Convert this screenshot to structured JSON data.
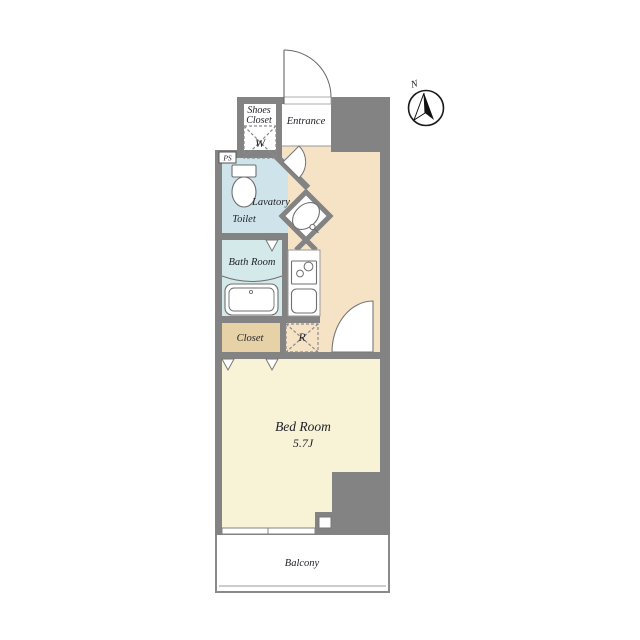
{
  "plan": {
    "title": "studio-apartment-floorplan",
    "compass": {
      "north_label": "N"
    },
    "labels": {
      "shoes_closet_line1": "Shoes",
      "shoes_closet_line2": "Closet",
      "entrance": "Entrance",
      "washer": "W",
      "pipe_space": "PS",
      "lavatory": "Lavatory",
      "toilet": "Toilet",
      "bath_room": "Bath Room",
      "closet": "Closet",
      "refrigerator": "R",
      "bedroom": "Bed Room",
      "bedroom_size": "5.7J",
      "balcony": "Balcony"
    },
    "colors": {
      "wall": "#838383",
      "hall_floor": "#f6e3c6",
      "bedroom_floor": "#f8f3d7",
      "toilet_floor": "#cfe4ea",
      "bath_floor": "#d4e9e9",
      "closet_floor": "#e6d2a6",
      "white": "#ffffff",
      "line": "#6f6f6f"
    }
  }
}
